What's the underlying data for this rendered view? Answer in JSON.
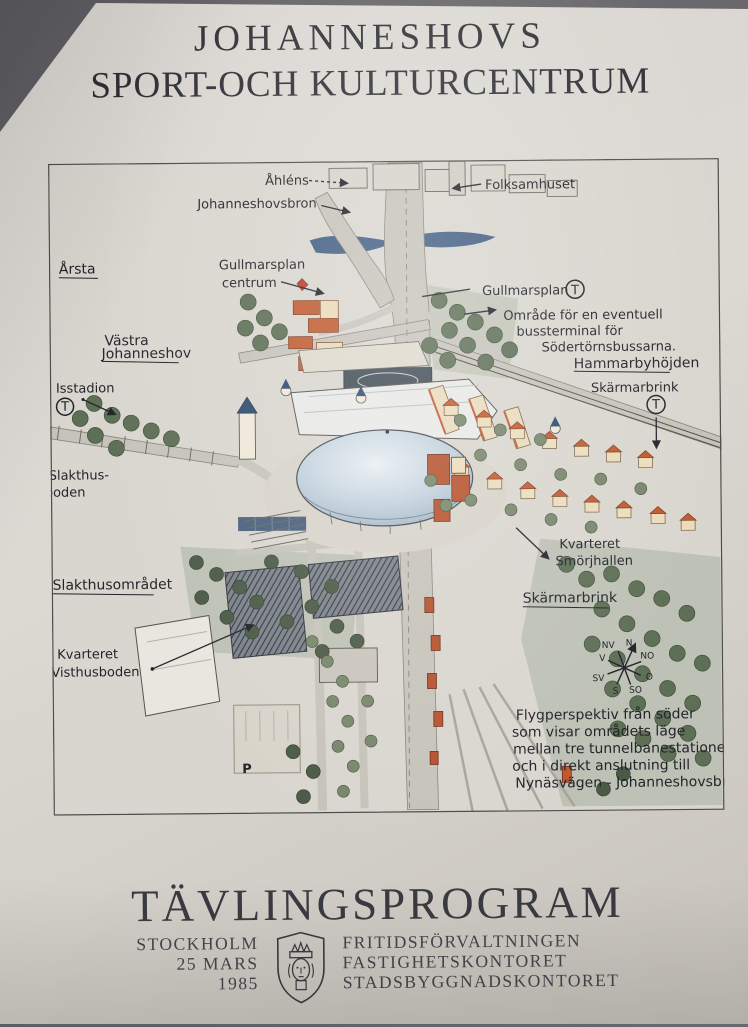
{
  "poster": {
    "title_line1": "JOHANNESHOVS",
    "title_line2": "SPORT-OCH KULTURCENTRUM",
    "footer": {
      "program_title": "TÄVLINGSPROGRAM",
      "place": "STOCKHOLM",
      "date_line": "25 MARS",
      "year": "1985",
      "org_1": "FRITIDSFÖRVALTNINGEN",
      "org_2": "FASTIGHETSKONTORET",
      "org_3": "STADSBYGGNADSKONTORET"
    }
  },
  "map": {
    "labels": {
      "ahlens": "Åhléns",
      "johanneshovsbron": "Johanneshovsbron",
      "folksamhuset": "Folksamhuset",
      "arsta": "Årsta",
      "gullmarsplan_centrum_1": "Gullmarsplan",
      "gullmarsplan_centrum_2": "centrum",
      "gullmarsplan_t": "Gullmarsplan",
      "bussterminal_1": "Område för en eventuell",
      "bussterminal_2": "bussterminal för",
      "bussterminal_3": "Södertörnsbussarna.",
      "vastra_1": "Västra",
      "vastra_2": "Johanneshov",
      "isstadion": "Isstadion",
      "hammarbyhojden": "Hammarbyhöjden",
      "skarmarbrink_ne": "Skärmarbrink",
      "slakthusboden_1": "Slakthus-",
      "slakthusboden_2": "boden",
      "slakthusomradet": "Slakthusområdet",
      "kvarteret_smorjhallen_1": "Kvarteret",
      "kvarteret_smorjhallen_2": "Smörjhallen",
      "skarmarbrink_se": "Skärmarbrink",
      "kvarteret_visthusboden_1": "Kvarteret",
      "kvarteret_visthusboden_2": "Visthusboden"
    },
    "symbols": {
      "metro": "T",
      "parking": "P"
    },
    "compass": {
      "n": "N",
      "no": "NO",
      "o": "O",
      "so": "SO",
      "s": "S",
      "sv": "SV",
      "v": "V",
      "nv": "NV"
    },
    "caption": [
      "Flygperspektiv från söder",
      "som visar områdets läge",
      "mellan tre tunnelbanestationer",
      "och i direkt anslutning till",
      "Nynäsvägen - Johanneshovsbron."
    ]
  },
  "colors": {
    "paper": "#d9d6d0",
    "ink": "#2c2d33",
    "water_blue": "#31517a",
    "road_gray": "#c6c3ba",
    "tree_green": "#5d6f55",
    "roof_orange": "#c2592e",
    "dome_blue": "#c3d2dd",
    "red_building": "#b5502c"
  }
}
